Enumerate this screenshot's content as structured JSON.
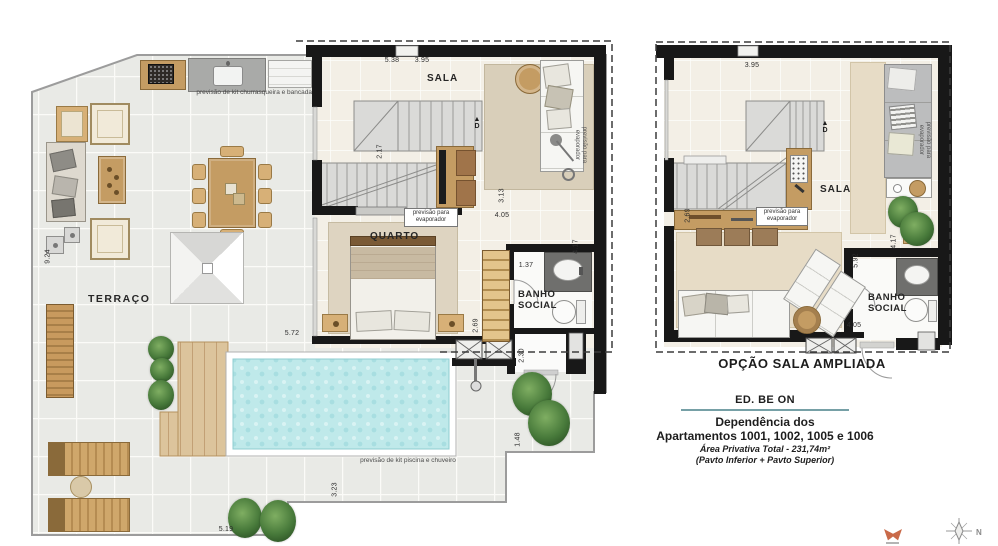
{
  "colors": {
    "wall": "#1a1a1a",
    "wood": "#c49c63",
    "pool_water": "#bfe9ea",
    "rug": "#d9cfba",
    "tile_floor": "#e9eae6",
    "accent_rule": "#76a0a6",
    "logo_orange": "#c96a49"
  },
  "plans": {
    "left": {
      "rooms": {
        "terraco": "TERRAÇO",
        "sala": "SALA",
        "quarto": "QUARTO",
        "banho": "BANHO\nSOCIAL"
      },
      "stair_marker": "▲\nD",
      "notes": {
        "churrasqueira": "previsão de kit churrasqueira e bancada",
        "piscina": "previsão de kit piscina e chuveiro",
        "evap_box": "previsão para\nevaporador",
        "evap_rot": "previsão para\nevaporador"
      },
      "dims": {
        "d924": "9.24",
        "d538": "5.38",
        "d395": "3.95",
        "d217": "2.17",
        "d313": "3.13",
        "d405": "4.05",
        "d137": "1.37",
        "d417": "4.17",
        "d269": "2.69",
        "d230": "2.30",
        "d572": "5.72",
        "d323": "3.23",
        "d148": "1.48",
        "d519": "5.19"
      }
    },
    "right": {
      "label": "OPÇÃO SALA AMPLIADA",
      "rooms": {
        "sala": "SALA",
        "banho": "BANHO\nSOCIAL"
      },
      "stair_marker": "▲\nD",
      "notes": {
        "evap_box": "previsão para\nevaporador",
        "evap_rot": "previsão para\nevaporador"
      },
      "dims": {
        "d395": "3.95",
        "d269": "2.69",
        "d592": "5.92",
        "d417": "4.17",
        "d405": "4.05"
      }
    }
  },
  "title_block": {
    "building": "ED. BE ON",
    "line1": "Dependência dos",
    "line2": "Apartamentos 1001, 1002, 1005 e 1006",
    "line3": "Área Privativa Total - 231,74m²",
    "line4": "(Pavto Inferior + Pavto Superior)"
  },
  "compass": {
    "label": "N"
  }
}
